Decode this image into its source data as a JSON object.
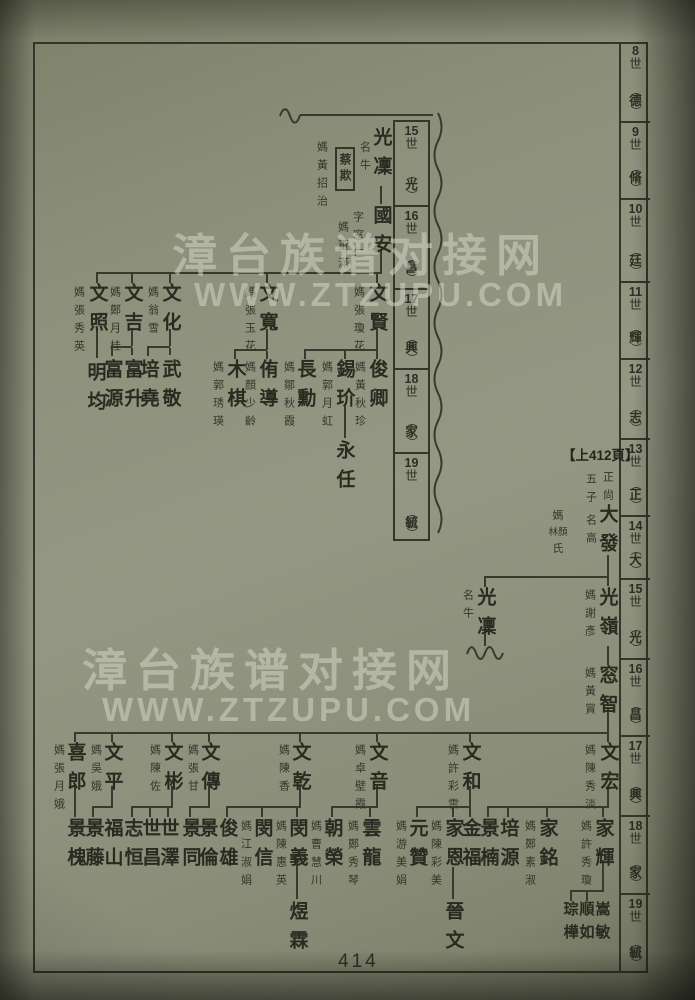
{
  "page_number": "414",
  "continued_marker": "【上412頁】",
  "watermark": {
    "line_cn": "漳台族谱对接网",
    "line_en": "WWW.ZTZUPU.COM"
  },
  "right_generation_ruler": [
    {
      "no": "8",
      "shi": "世",
      "char": "德",
      "y": 42,
      "h": 81
    },
    {
      "no": "9",
      "shi": "世",
      "char": "脩",
      "y": 123,
      "h": 77
    },
    {
      "no": "10",
      "shi": "世",
      "char": "廷",
      "y": 200,
      "h": 83
    },
    {
      "no": "11",
      "shi": "世",
      "char": "輝",
      "y": 283,
      "h": 77
    },
    {
      "no": "12",
      "shi": "世",
      "char": "志",
      "y": 360,
      "h": 80
    },
    {
      "no": "13",
      "shi": "世",
      "char": "正",
      "y": 440,
      "h": 77
    },
    {
      "no": "14",
      "shi": "世",
      "char": "大",
      "y": 517,
      "h": 63
    },
    {
      "no": "15",
      "shi": "世",
      "char": "光",
      "y": 580,
      "h": 80
    },
    {
      "no": "16",
      "shi": "世",
      "char": "昌",
      "y": 660,
      "h": 77
    },
    {
      "no": "17",
      "shi": "世",
      "char": "興",
      "y": 737,
      "h": 80
    },
    {
      "no": "18",
      "shi": "世",
      "char": "家",
      "y": 817,
      "h": 78
    },
    {
      "no": "19",
      "shi": "世",
      "char": "毓",
      "y": 895,
      "h": 78
    }
  ],
  "inset_generation_ruler": [
    {
      "no": "15",
      "shi": "世",
      "char": "光",
      "y": 120,
      "h": 85
    },
    {
      "no": "16",
      "shi": "世",
      "char": "昌",
      "y": 205,
      "h": 83
    },
    {
      "no": "17",
      "shi": "世",
      "char": "興",
      "y": 288,
      "h": 80
    },
    {
      "no": "18",
      "shi": "世",
      "char": "家",
      "y": 368,
      "h": 84
    },
    {
      "no": "19",
      "shi": "世",
      "char": "毓",
      "y": 452,
      "h": 89
    }
  ],
  "special_spouse": {
    "prefix": "媽",
    "pair": "林顏",
    "suffix": "氏",
    "x": 558,
    "y": 511
  },
  "nodes": [
    {
      "t": "光凜",
      "x": 381,
      "y": 127,
      "k": "name"
    },
    {
      "t": "名牛",
      "x": 364,
      "y": 141,
      "k": "note"
    },
    {
      "t": "蔡欺",
      "x": 345,
      "y": 147,
      "k": "box"
    },
    {
      "t": "媽黃招治",
      "x": 321,
      "y": 141,
      "k": "spouse"
    },
    {
      "t": "國安",
      "x": 381,
      "y": 205,
      "k": "name"
    },
    {
      "t": "字窓仁",
      "x": 357,
      "y": 211,
      "k": "note"
    },
    {
      "t": "媽董滿",
      "x": 342,
      "y": 221,
      "k": "spouse"
    },
    {
      "t": "文賢",
      "x": 377,
      "y": 283,
      "k": "name"
    },
    {
      "t": "媽張瓊花",
      "x": 358,
      "y": 286,
      "k": "spouse"
    },
    {
      "t": "文寬",
      "x": 267,
      "y": 283,
      "k": "name"
    },
    {
      "t": "媽張玉花",
      "x": 249,
      "y": 286,
      "k": "spouse"
    },
    {
      "t": "文化",
      "x": 170,
      "y": 283,
      "k": "name"
    },
    {
      "t": "媽翁雪",
      "x": 152,
      "y": 286,
      "k": "spouse"
    },
    {
      "t": "文吉",
      "x": 132,
      "y": 283,
      "k": "name"
    },
    {
      "t": "媽鄭月桂",
      "x": 114,
      "y": 286,
      "k": "spouse"
    },
    {
      "t": "文照",
      "x": 97,
      "y": 283,
      "k": "name"
    },
    {
      "t": "媽張秀英",
      "x": 78,
      "y": 286,
      "k": "spouse"
    },
    {
      "t": "俊卿",
      "x": 377,
      "y": 359,
      "k": "name"
    },
    {
      "t": "媽黃秋珍",
      "x": 359,
      "y": 361,
      "k": "spouse"
    },
    {
      "t": "錫玠",
      "x": 344,
      "y": 359,
      "k": "name"
    },
    {
      "t": "媽郭月虹",
      "x": 326,
      "y": 361,
      "k": "spouse"
    },
    {
      "t": "長勳",
      "x": 305,
      "y": 359,
      "k": "name"
    },
    {
      "t": "媽鄒秋霞",
      "x": 288,
      "y": 361,
      "k": "spouse"
    },
    {
      "t": "侑導",
      "x": 267,
      "y": 359,
      "k": "name"
    },
    {
      "t": "媽顏少齡",
      "x": 249,
      "y": 361,
      "k": "spouse"
    },
    {
      "t": "木棋",
      "x": 235,
      "y": 359,
      "k": "name"
    },
    {
      "t": "媽郭琇瑛",
      "x": 217,
      "y": 361,
      "k": "spouse"
    },
    {
      "t": "武敬",
      "x": 170,
      "y": 359,
      "k": "name"
    },
    {
      "t": "培堯",
      "x": 148,
      "y": 359,
      "k": "name"
    },
    {
      "t": "富升",
      "x": 132,
      "y": 359,
      "k": "name"
    },
    {
      "t": "富源",
      "x": 112,
      "y": 359,
      "k": "name"
    },
    {
      "t": "明均",
      "x": 95,
      "y": 362,
      "k": "name"
    },
    {
      "t": "永任",
      "x": 344,
      "y": 440,
      "k": "name"
    },
    {
      "t": "正尙",
      "x": 607,
      "y": 471,
      "k": "note"
    },
    {
      "t": "五子",
      "x": 590,
      "y": 473,
      "k": "note"
    },
    {
      "t": "大發",
      "x": 607,
      "y": 504,
      "k": "name"
    },
    {
      "t": "名高",
      "x": 590,
      "y": 514,
      "k": "note"
    },
    {
      "t": "光嶺",
      "x": 607,
      "y": 587,
      "k": "name"
    },
    {
      "t": "媽謝彥",
      "x": 589,
      "y": 589,
      "k": "spouse"
    },
    {
      "t": "光凜",
      "x": 485,
      "y": 587,
      "k": "name"
    },
    {
      "t": "名牛",
      "x": 467,
      "y": 589,
      "k": "note"
    },
    {
      "t": "窓智",
      "x": 607,
      "y": 665,
      "k": "name"
    },
    {
      "t": "媽黃賞",
      "x": 589,
      "y": 667,
      "k": "spouse"
    },
    {
      "t": "文宏",
      "x": 608,
      "y": 742,
      "k": "name"
    },
    {
      "t": "媽陳秀淡",
      "x": 589,
      "y": 744,
      "k": "spouse"
    },
    {
      "t": "文和",
      "x": 470,
      "y": 742,
      "k": "name"
    },
    {
      "t": "媽許彩雲",
      "x": 452,
      "y": 744,
      "k": "spouse"
    },
    {
      "t": "文音",
      "x": 377,
      "y": 742,
      "k": "name"
    },
    {
      "t": "媽卓壁霞",
      "x": 359,
      "y": 744,
      "k": "spouse"
    },
    {
      "t": "文乾",
      "x": 300,
      "y": 742,
      "k": "name"
    },
    {
      "t": "媽陳香",
      "x": 283,
      "y": 744,
      "k": "spouse"
    },
    {
      "t": "文傳",
      "x": 209,
      "y": 742,
      "k": "name"
    },
    {
      "t": "媽張甘",
      "x": 192,
      "y": 744,
      "k": "spouse"
    },
    {
      "t": "文彬",
      "x": 172,
      "y": 742,
      "k": "name"
    },
    {
      "t": "媽陳佐",
      "x": 154,
      "y": 744,
      "k": "spouse"
    },
    {
      "t": "文平",
      "x": 112,
      "y": 742,
      "k": "name"
    },
    {
      "t": "媽吳娥",
      "x": 95,
      "y": 744,
      "k": "spouse"
    },
    {
      "t": "喜郎",
      "x": 75,
      "y": 742,
      "k": "name"
    },
    {
      "t": "媽張月娥",
      "x": 58,
      "y": 744,
      "k": "spouse"
    },
    {
      "t": "家輝",
      "x": 603,
      "y": 818,
      "k": "name"
    },
    {
      "t": "媽許秀瓊",
      "x": 585,
      "y": 820,
      "k": "spouse"
    },
    {
      "t": "家銘",
      "x": 547,
      "y": 818,
      "k": "name"
    },
    {
      "t": "媽鄭素淑",
      "x": 529,
      "y": 820,
      "k": "spouse"
    },
    {
      "t": "培源",
      "x": 508,
      "y": 818,
      "k": "name"
    },
    {
      "t": "景楠",
      "x": 488,
      "y": 818,
      "k": "name"
    },
    {
      "t": "金福",
      "x": 470,
      "y": 818,
      "k": "name"
    },
    {
      "t": "家恩",
      "x": 453,
      "y": 818,
      "k": "name"
    },
    {
      "t": "媽陳彩美",
      "x": 435,
      "y": 820,
      "k": "spouse"
    },
    {
      "t": "元贊",
      "x": 417,
      "y": 818,
      "k": "name"
    },
    {
      "t": "媽游美娟",
      "x": 400,
      "y": 820,
      "k": "spouse"
    },
    {
      "t": "雲龍",
      "x": 370,
      "y": 818,
      "k": "name"
    },
    {
      "t": "媽鄭秀琴",
      "x": 352,
      "y": 820,
      "k": "spouse"
    },
    {
      "t": "朝榮",
      "x": 332,
      "y": 818,
      "k": "name"
    },
    {
      "t": "媽曹慧川",
      "x": 315,
      "y": 820,
      "k": "spouse"
    },
    {
      "t": "閔義",
      "x": 297,
      "y": 818,
      "k": "name"
    },
    {
      "t": "媽陳惠英",
      "x": 280,
      "y": 820,
      "k": "spouse"
    },
    {
      "t": "閔信",
      "x": 262,
      "y": 818,
      "k": "name"
    },
    {
      "t": "媽江淑娟",
      "x": 245,
      "y": 820,
      "k": "spouse"
    },
    {
      "t": "俊雄",
      "x": 227,
      "y": 818,
      "k": "name"
    },
    {
      "t": "景倫",
      "x": 207,
      "y": 818,
      "k": "name"
    },
    {
      "t": "景同",
      "x": 190,
      "y": 818,
      "k": "name"
    },
    {
      "t": "世澤",
      "x": 168,
      "y": 818,
      "k": "name"
    },
    {
      "t": "世昌",
      "x": 150,
      "y": 818,
      "k": "name"
    },
    {
      "t": "志恒",
      "x": 132,
      "y": 818,
      "k": "name"
    },
    {
      "t": "福山",
      "x": 112,
      "y": 818,
      "k": "name"
    },
    {
      "t": "景藤",
      "x": 93,
      "y": 818,
      "k": "name"
    },
    {
      "t": "景槐",
      "x": 75,
      "y": 818,
      "k": "name"
    },
    {
      "t": "嵩敏",
      "x": 602,
      "y": 901,
      "k": "tight"
    },
    {
      "t": "順如",
      "x": 586,
      "y": 901,
      "k": "tight"
    },
    {
      "t": "琮樺",
      "x": 570,
      "y": 901,
      "k": "tight"
    },
    {
      "t": "晉文",
      "x": 453,
      "y": 901,
      "k": "name"
    },
    {
      "t": "煜霖",
      "x": 297,
      "y": 901,
      "k": "name"
    }
  ],
  "tree_lines": [
    [
      300,
      114,
      133,
      2
    ],
    [
      380,
      186,
      2,
      18
    ],
    [
      380,
      250,
      2,
      24
    ],
    [
      96,
      272,
      286,
      2
    ],
    [
      376,
      274,
      2,
      9
    ],
    [
      266,
      274,
      2,
      9
    ],
    [
      169,
      274,
      2,
      9
    ],
    [
      131,
      274,
      2,
      9
    ],
    [
      96,
      274,
      2,
      9
    ],
    [
      376,
      329,
      2,
      21
    ],
    [
      304,
      349,
      74,
      2
    ],
    [
      344,
      351,
      2,
      8
    ],
    [
      304,
      351,
      2,
      8
    ],
    [
      376,
      351,
      2,
      8
    ],
    [
      266,
      329,
      2,
      21
    ],
    [
      234,
      349,
      33,
      2
    ],
    [
      234,
      351,
      2,
      8
    ],
    [
      266,
      351,
      2,
      8
    ],
    [
      169,
      329,
      2,
      17
    ],
    [
      147,
      346,
      23,
      2
    ],
    [
      147,
      348,
      2,
      8
    ],
    [
      169,
      348,
      2,
      7
    ],
    [
      131,
      329,
      2,
      17
    ],
    [
      111,
      346,
      21,
      2
    ],
    [
      111,
      348,
      2,
      8
    ],
    [
      131,
      348,
      2,
      7
    ],
    [
      96,
      329,
      2,
      29
    ],
    [
      344,
      406,
      2,
      32
    ],
    [
      607,
      555,
      2,
      22
    ],
    [
      484,
      576,
      125,
      2
    ],
    [
      484,
      578,
      2,
      9
    ],
    [
      607,
      578,
      2,
      8
    ],
    [
      484,
      628,
      2,
      18
    ],
    [
      607,
      646,
      2,
      19
    ],
    [
      607,
      708,
      2,
      25
    ],
    [
      74,
      732,
      535,
      2
    ],
    [
      607,
      734,
      2,
      8
    ],
    [
      469,
      734,
      2,
      8
    ],
    [
      376,
      734,
      2,
      8
    ],
    [
      299,
      734,
      2,
      8
    ],
    [
      208,
      734,
      2,
      8
    ],
    [
      171,
      734,
      2,
      8
    ],
    [
      111,
      734,
      2,
      8
    ],
    [
      74,
      734,
      2,
      8
    ],
    [
      607,
      786,
      2,
      22
    ],
    [
      487,
      806,
      122,
      2
    ],
    [
      602,
      808,
      2,
      9
    ],
    [
      546,
      808,
      2,
      9
    ],
    [
      507,
      808,
      2,
      9
    ],
    [
      487,
      808,
      2,
      9
    ],
    [
      469,
      786,
      2,
      22
    ],
    [
      416,
      806,
      55,
      2
    ],
    [
      452,
      808,
      2,
      9
    ],
    [
      416,
      808,
      2,
      9
    ],
    [
      469,
      808,
      2,
      9
    ],
    [
      376,
      786,
      2,
      22
    ],
    [
      331,
      806,
      47,
      2
    ],
    [
      369,
      808,
      2,
      9
    ],
    [
      331,
      808,
      2,
      9
    ],
    [
      299,
      786,
      2,
      22
    ],
    [
      226,
      806,
      75,
      2
    ],
    [
      296,
      808,
      2,
      9
    ],
    [
      261,
      808,
      2,
      9
    ],
    [
      226,
      808,
      2,
      9
    ],
    [
      208,
      786,
      2,
      22
    ],
    [
      189,
      806,
      21,
      2
    ],
    [
      189,
      808,
      2,
      9
    ],
    [
      171,
      786,
      2,
      22
    ],
    [
      131,
      806,
      42,
      2
    ],
    [
      149,
      808,
      2,
      9
    ],
    [
      131,
      808,
      2,
      9
    ],
    [
      167,
      808,
      2,
      9
    ],
    [
      111,
      786,
      2,
      22
    ],
    [
      92,
      806,
      21,
      2
    ],
    [
      92,
      808,
      2,
      9
    ],
    [
      74,
      786,
      2,
      31
    ],
    [
      602,
      861,
      2,
      31
    ],
    [
      570,
      890,
      34,
      2
    ],
    [
      586,
      892,
      2,
      9
    ],
    [
      570,
      892,
      2,
      9
    ],
    [
      452,
      867,
      2,
      32
    ],
    [
      296,
      859,
      2,
      40
    ]
  ]
}
